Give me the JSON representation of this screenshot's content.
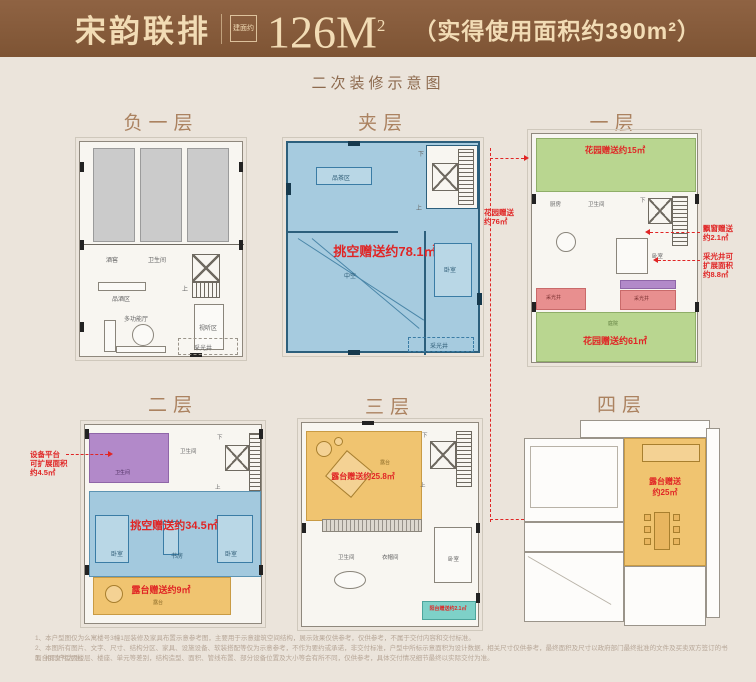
{
  "header": {
    "title": "宋韵联排",
    "seal": "建面约",
    "area_value": "126M",
    "area_sup": "2",
    "area_note": "（实得使用面积约390m²）"
  },
  "subtitle": "二次装修示意图",
  "colors": {
    "header_brown": "#8a5e3e",
    "cream_text": "#f2dcb5",
    "red_note": "#e02525",
    "blue_fill": "#a3c9de",
    "orange_fill": "#f0c470",
    "green_fill": "#b9d690",
    "pink_fill": "#e88f8f",
    "purple_fill": "#b289c9",
    "teal_fill": "#7ed1c8"
  },
  "floors": {
    "b1": {
      "label": "负一层",
      "rooms": {
        "wine_cellar": "酒窖",
        "bathroom": "卫生间",
        "tasting": "品酒区",
        "hall": "多功能厅",
        "av_room": "视听区",
        "light_well": "采光井",
        "up": "上"
      }
    },
    "mezzanine": {
      "label": "夹层",
      "gift_void": "挑空赠送约78.1㎡",
      "rooms": {
        "tea": "品茶区",
        "void": "中空",
        "bedroom": "卧室",
        "light_well": "采光井",
        "up": "上",
        "down": "下"
      }
    },
    "f1": {
      "label": "一层",
      "gift_garden_top": "花园赠送约15㎡",
      "gift_garden_bottom": "花园赠送约61㎡",
      "ann_garden_left_1": "花园赠送",
      "ann_garden_left_2": "约76㎡",
      "ann_bay_1": "飘窗赠送",
      "ann_bay_2": "约2.1㎡",
      "ann_well_1": "采光井可",
      "ann_well_2": "扩展面积",
      "ann_well_3": "约8.8㎡",
      "rooms": {
        "kitchen": "厨房",
        "bathroom": "卫生间",
        "bedroom": "卧室",
        "courtyard": "庭院",
        "light_well_l": "采光井",
        "light_well_r": "采光井",
        "up": "上",
        "down": "下"
      }
    },
    "f2": {
      "label": "二层",
      "gift_void": "挑空赠送约34.5㎡",
      "gift_terrace": "露台赠送约9㎡",
      "ann_equip_1": "设备平台",
      "ann_equip_2": "可扩展面积",
      "ann_equip_3": "约4.5㎡",
      "rooms": {
        "bathroom_purple": "卫生间",
        "bathroom": "卫生间",
        "bedroom_l": "卧室",
        "study": "书房",
        "bedroom_r": "卧室",
        "terrace": "露台",
        "up": "上",
        "down": "下"
      }
    },
    "f3": {
      "label": "三层",
      "gift_terrace": "露台赠送约25.8㎡",
      "gift_balcony": "阳台赠送约2.1㎡",
      "rooms": {
        "terrace": "露台",
        "bathroom": "卫生间",
        "cloakroom": "衣帽间",
        "bedroom": "卧室",
        "up": "上",
        "down": "下"
      }
    },
    "f4": {
      "label": "四层",
      "gift_terrace_1": "露台赠送",
      "gift_terrace_2": "约25㎡"
    }
  },
  "disclaimer": {
    "line1": "1、本户型图仅为么寓楼号3幢1层装修及家具布置示意参考图，主要用于示意建筑空间结构，展示效果仅供参考，仅供参考，不属于交付内容和交付标准。",
    "line2": "2、本图所有图片、文字、尺寸、结构分区、家具、设施设备、软装搭配等仅为示意参考，不作为要约或承诺，非交付标准，户型中所标示意面积为设计数据，相关尺寸仅供参考，最终面积及尺寸以政府部门最终批准的文件及买卖双方签订的书面合同文件为准。",
    "line3": "3、相同户型因楼层、楼座、单元等差别，结构造型、面积、管线布置、部分设备位置及大小等会有所不同，仅供参考，具体交付情况细节最终以实际交付为准。"
  }
}
